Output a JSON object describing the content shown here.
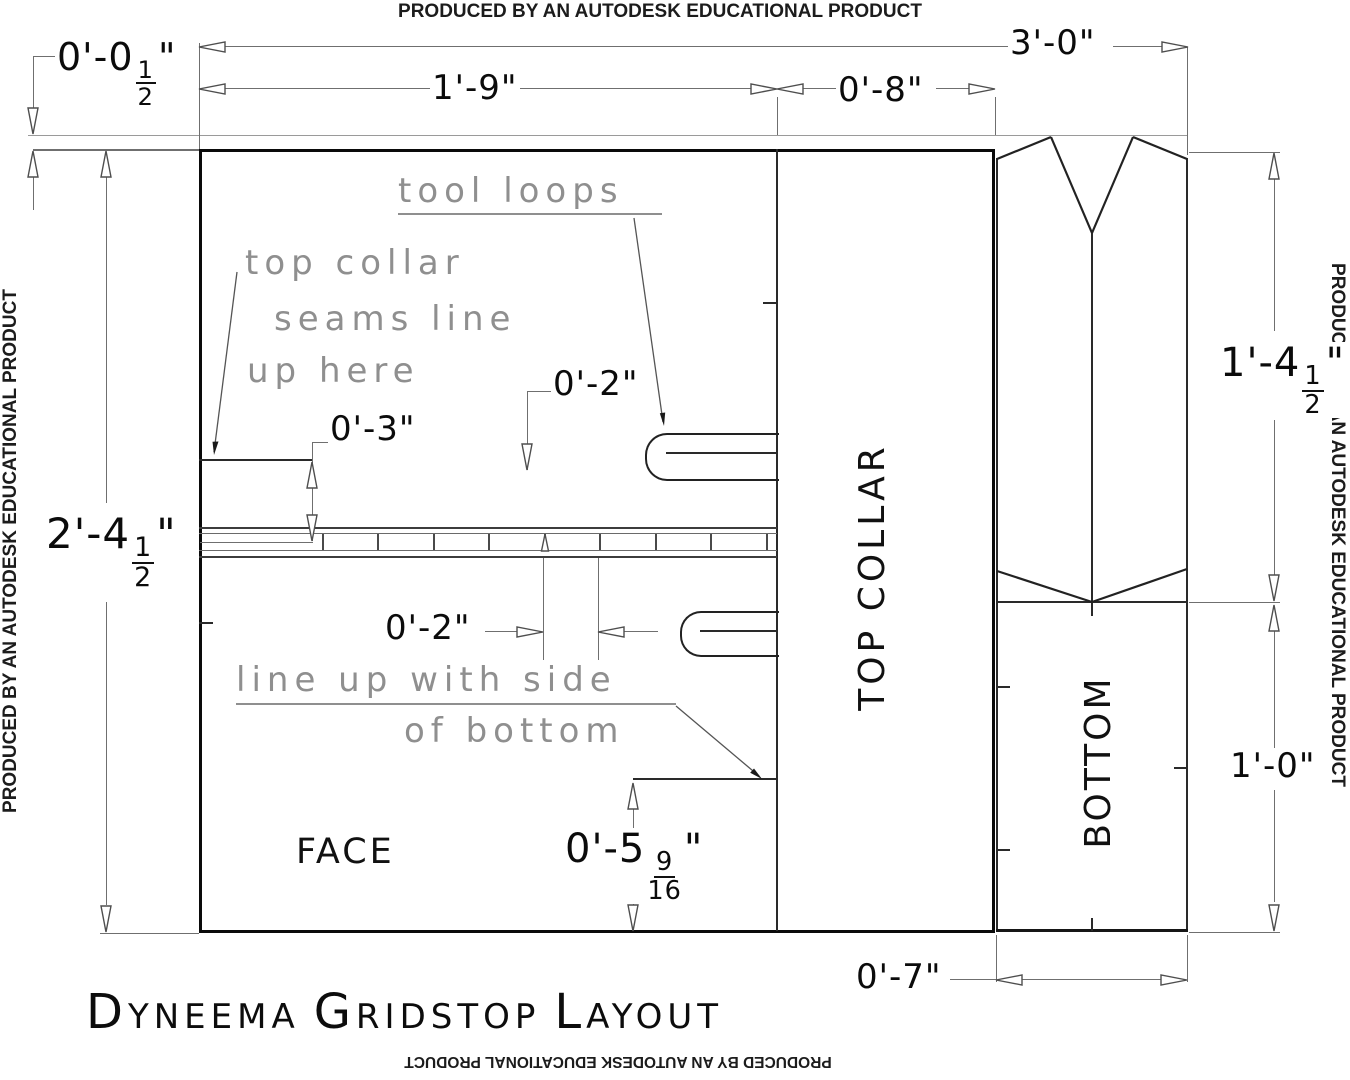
{
  "watermark": {
    "text": "PRODUCED BY AN AUTODESK EDUCATIONAL PRODUCT"
  },
  "title": {
    "word1": "Dyneema",
    "word2": "Gridstop",
    "word3": "Layout"
  },
  "panels": {
    "face": "FACE",
    "top_collar": "TOP COLLAR",
    "bottom": "BOTTOM"
  },
  "notes": {
    "tool_loops": "tool loops",
    "seam_line1": "top collar",
    "seam_line2": "seams line",
    "seam_line3": "up here",
    "align_line1": "line up with side",
    "align_line2": "of bottom"
  },
  "dims": {
    "overall_width": "3'-0\"",
    "face_width": "1'-9\"",
    "top_collar_width": "0'-8\"",
    "seam_allowance": {
      "pre": "0'-0",
      "num": "1",
      "den": "2",
      "post": "\""
    },
    "overall_height": {
      "pre": "2'-4",
      "num": "1",
      "den": "2",
      "post": "\""
    },
    "seam_offset": "0'-3\"",
    "tool_loop_offset": "0'-2\"",
    "grid_spacing": "0'-2\"",
    "step_height": {
      "pre": "0'-5",
      "num": "9",
      "den": "16",
      "post": "\""
    },
    "bottom_upper_height": {
      "pre": "1'-4",
      "num": "1",
      "den": "2",
      "post": "\""
    },
    "bottom_lower_height": "1'-0\"",
    "bottom_width": "0'-7\""
  }
}
